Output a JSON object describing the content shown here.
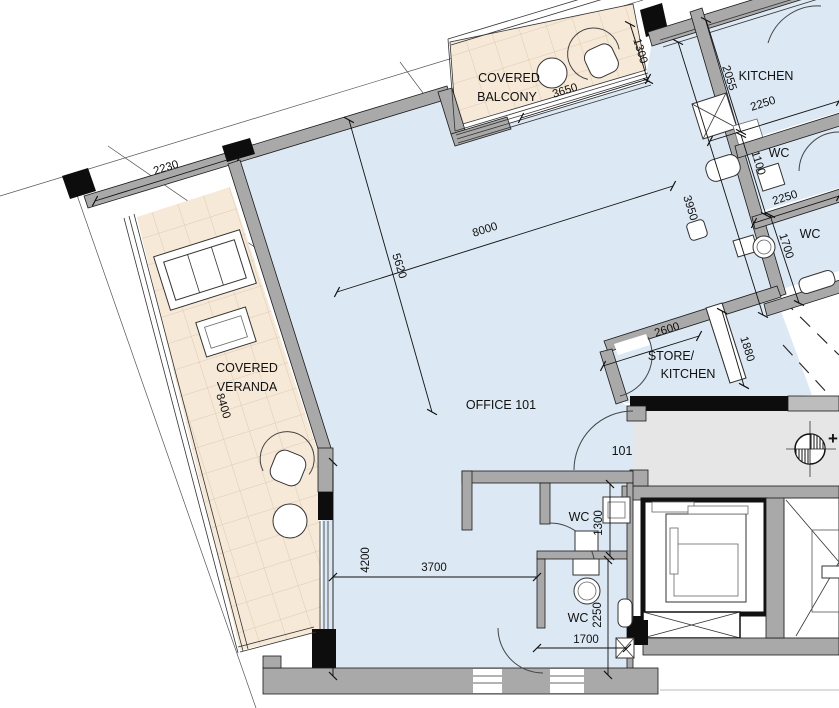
{
  "plan": {
    "rooms": {
      "office": {
        "label": "OFFICE 101"
      },
      "balcony": {
        "line1": "COVERED",
        "line2": "BALCONY"
      },
      "veranda": {
        "line1": "COVERED",
        "line2": "VERANDA"
      },
      "kitchen": {
        "label": "KITCHEN"
      },
      "store": {
        "line1": "STORE/",
        "line2": "KITCHEN"
      },
      "wc_top_a": {
        "label": "WC"
      },
      "wc_top_b": {
        "label": "WC"
      },
      "wc_mid": {
        "label": "WC"
      },
      "wc_bottom": {
        "label": "WC"
      }
    },
    "door_tags": {
      "unit_entrance": "101"
    },
    "dimensions_mm": {
      "top_left_wall": "2230",
      "balcony_length": "3650",
      "balcony_depth": "1300",
      "kitchen_depth": "2055",
      "kitchen_width": "2250",
      "wc_top_a_depth": "1100",
      "wc_top_mid": "2250",
      "wc_top_b_depth": "1700",
      "office_width": "8000",
      "office_grid": "5620",
      "office_east": "3950",
      "store_width": "2600",
      "duct": "1880",
      "veranda_length": "8400",
      "office_south_height": "4200",
      "office_south_width": "3700",
      "wc_mid_width": "1300",
      "wc_bottom_depth": "2250",
      "wc_bottom_width": "1700"
    },
    "symbols": {
      "benchmark_plus": "+"
    },
    "colors": {
      "floor_blue": "#dce8f3",
      "terrace_peach": "#f7e9d8",
      "tile_line": "#dcc9b2",
      "wall_gray": "#a9a9a9",
      "wall_black": "#0d0d0d",
      "corridor_gray": "#e6e6e6"
    }
  }
}
